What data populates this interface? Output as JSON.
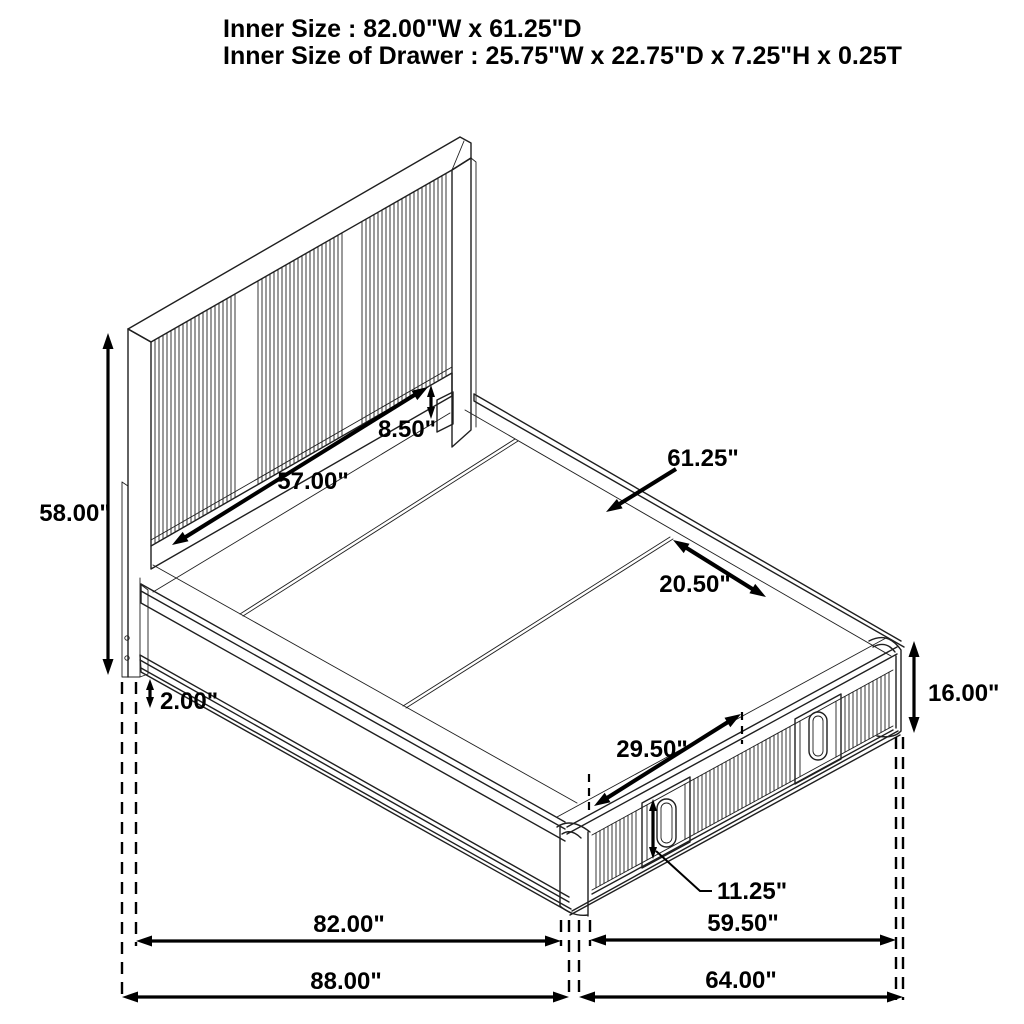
{
  "title": {
    "line1": "Inner Size : 82.00\"W x 61.25\"D",
    "line2": "Inner Size of Drawer : 25.75\"W x 22.75\"D x 7.25\"H x 0.25T"
  },
  "dimensions": {
    "headboard_height": "58.00\"",
    "floor_clearance": "2.00\"",
    "headboard_panel_width": "57.00\"",
    "headboard_gap_height": "8.50\"",
    "inner_depth": "61.25\"",
    "deck_panel_width": "20.50\"",
    "footboard_height": "16.00\"",
    "drawer_width": "29.50\"",
    "drawer_front_height": "11.25\"",
    "inner_width": "82.00\"",
    "overall_width": "88.00\"",
    "drawer_section_width": "59.50\"",
    "overall_depth": "64.00\""
  },
  "colors": {
    "line": "#1f1f1f",
    "dimension": "#000000",
    "background": "#ffffff"
  }
}
